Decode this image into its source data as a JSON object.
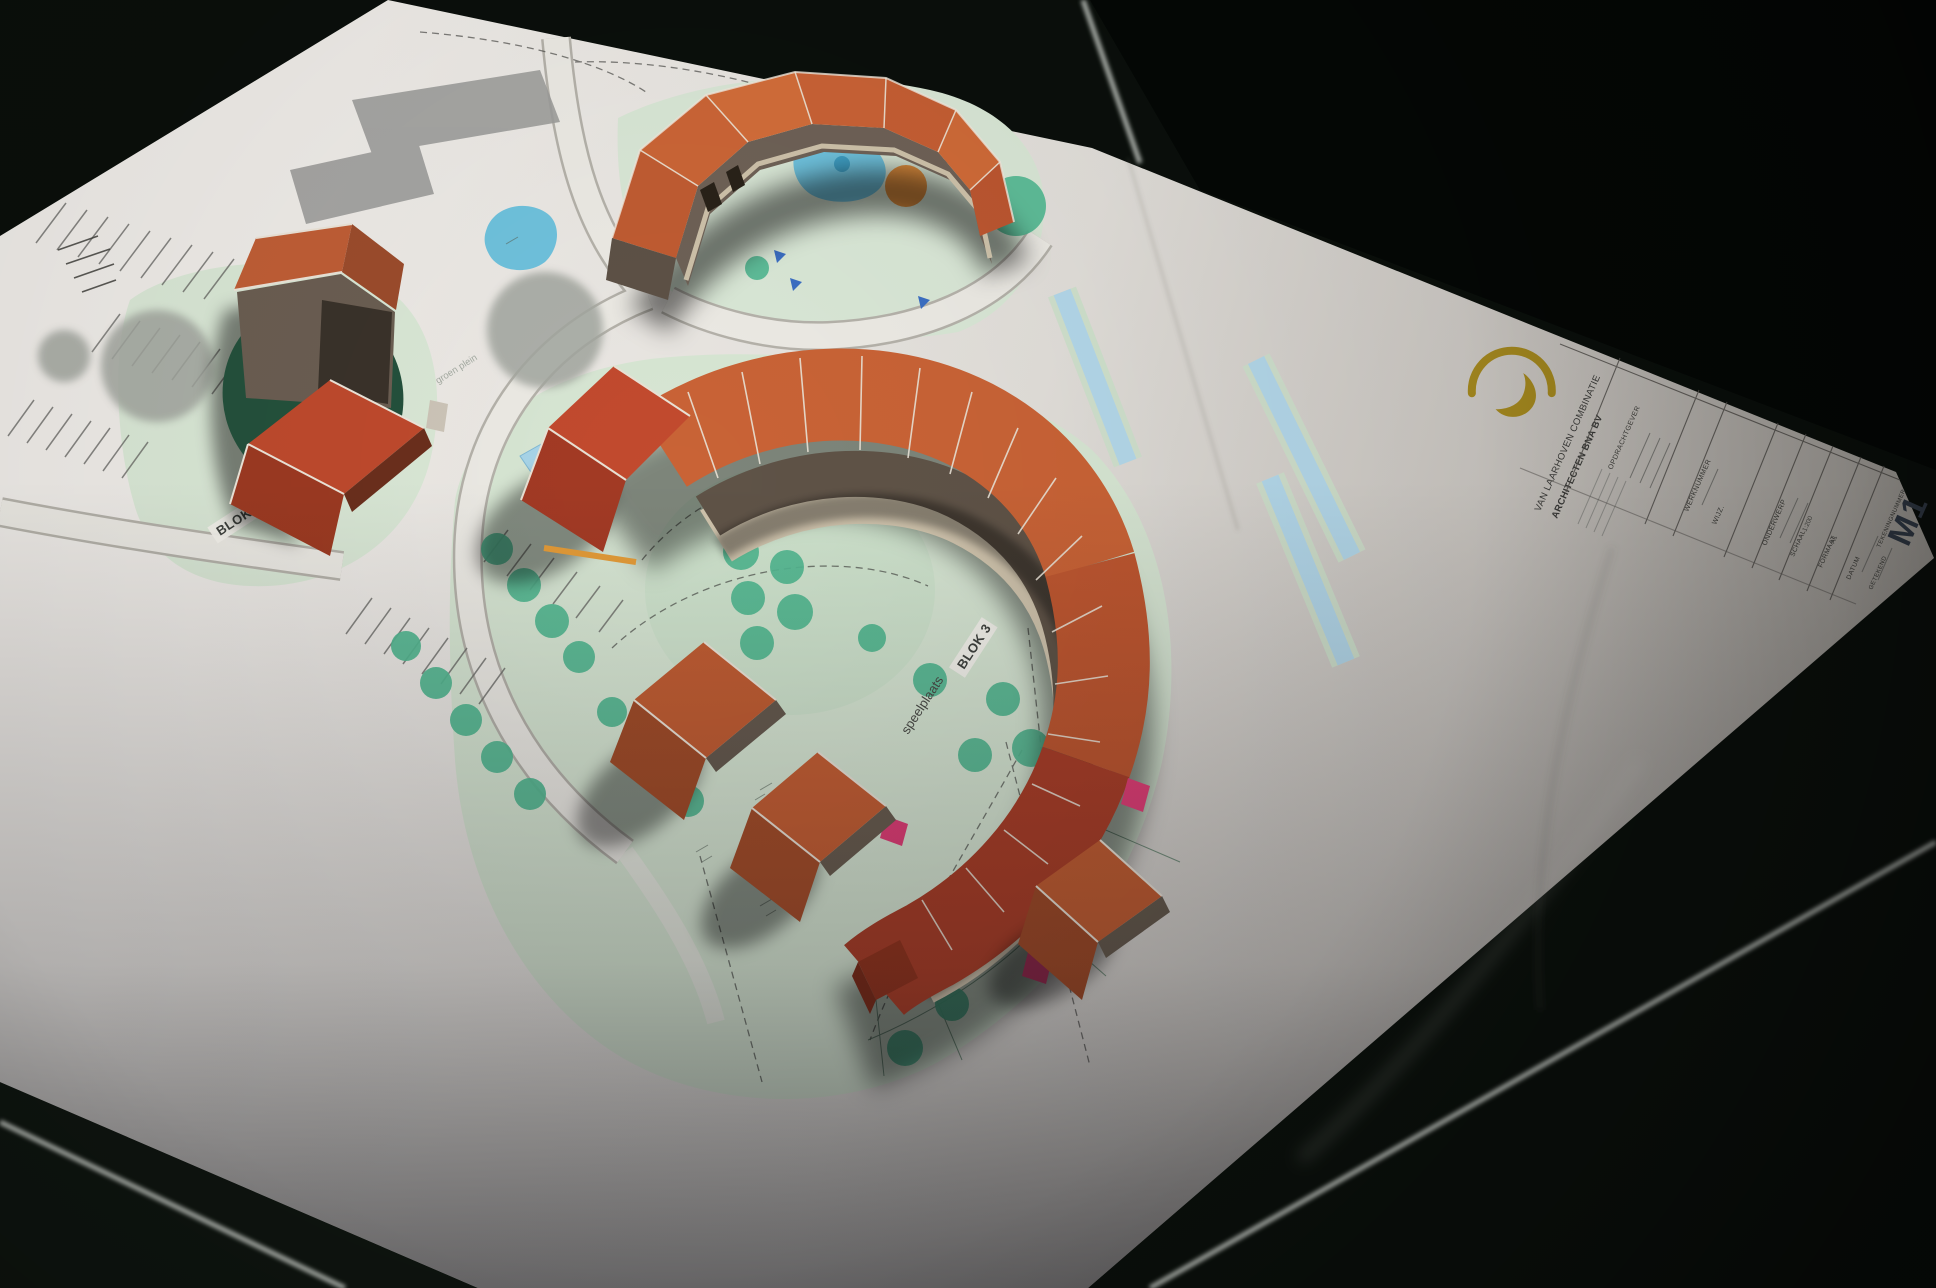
{
  "plan": {
    "labels": {
      "blok1": "BLOK 1",
      "blok3": "BLOK 3",
      "speelplaats": "speelplaats",
      "groen_plein": "groen plein"
    }
  },
  "title_block": {
    "company_line1": "VAN LAARHOVEN COMBINATIE",
    "company_line2": "ARCHITECTEN BNA BV",
    "fields": [
      {
        "label": "OPDRACHTGEVER",
        "value": ""
      },
      {
        "label": "WERKNUMMER",
        "value": ""
      },
      {
        "label": "WIJZ.",
        "value": ""
      },
      {
        "label": "ONDERWERP",
        "value": ""
      },
      {
        "label": "SCHAAL",
        "value": "1:200"
      },
      {
        "label": "FORMAAT",
        "value": "A1"
      },
      {
        "label": "DATUM",
        "value": ""
      },
      {
        "label": "GETEKEND",
        "value": ""
      },
      {
        "label": "TEKENINGNUMMER",
        "value": ""
      }
    ],
    "sheet_code": "M1"
  },
  "colors": {
    "floor": "#0a0f0b",
    "paper": "#e7e4df",
    "roof_orange": "#c96336",
    "roof_red": "#ab3f28",
    "facade_brown": "#6e6156",
    "tree_teal": "#54b992",
    "water_blue": "#6fc2dd",
    "accent_pink": "#e23f77",
    "logo_gold": "#a5891f",
    "court_green": "#24513c"
  }
}
